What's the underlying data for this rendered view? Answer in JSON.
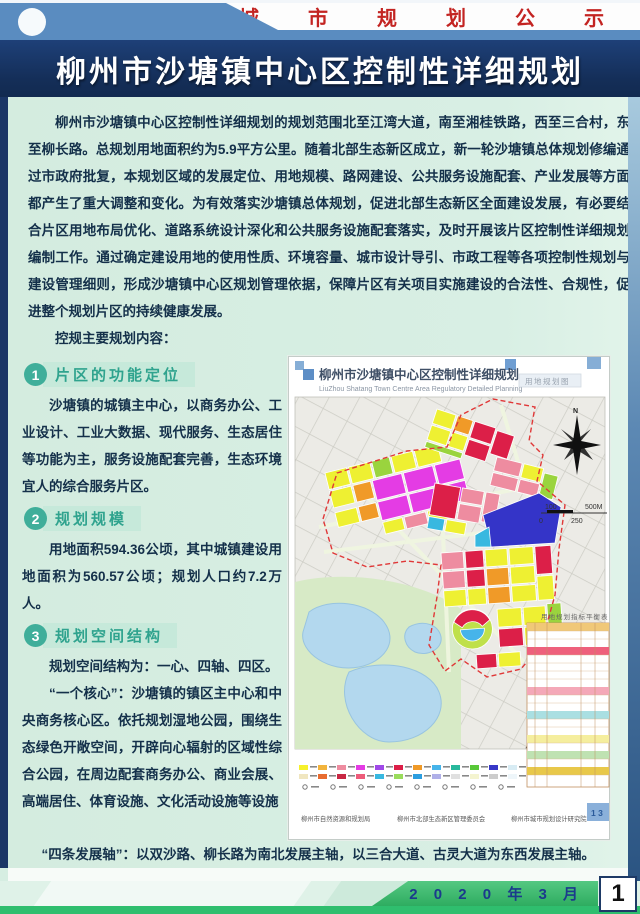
{
  "banner": {
    "title": "城 市 规 划 公 示"
  },
  "header": {
    "title": "柳州市沙塘镇中心区控制性详细规划"
  },
  "intro": {
    "paragraph": "柳州市沙塘镇中心区控制性详细规划的规划范围北至江湾大道，南至湘桂铁路，西至三合村，东至柳长路。总规划用地面积约为5.9平方公里。随着北部生态新区成立，新一轮沙塘镇总体规划修编通过市政府批复，本规划区域的发展定位、用地规模、路网建设、公共服务设施配套、产业发展等方面都产生了重大调整和变化。为有效落实沙塘镇总体规划，促进北部生态新区全面建设发展，有必要结合片区用地布局优化、道路系统设计深化和公共服务设施配套落实，及时开展该片区控制性详细规划编制工作。通过确定建设用地的使用性质、环境容量、城市设计导引、市政工程等各项控制性规划与建设管理细则，形成沙塘镇中心区规划管理依据，保障片区有关项目实施建设的合法性、合规性，促进整个规划片区的持续健康发展。",
    "lead_in": "控规主要规划内容："
  },
  "sections": [
    {
      "num": "1",
      "title": "片区的功能定位",
      "body": "沙塘镇的城镇主中心，以商务办公、工业设计、工业大数据、现代服务、生态居住等功能为主，服务设施配套完善，生态环境宜人的综合服务片区。"
    },
    {
      "num": "2",
      "title": "规划规模",
      "body": "用地面积594.36公顷，其中城镇建设用地面积为560.57公顷；规划人口约7.2万人。"
    },
    {
      "num": "3",
      "title": "规划空间结构",
      "body": "规划空间结构为：一心、四轴、四区。",
      "body2": "“一个核心”：沙塘镇的镇区主中心和中央商务核心区。依托规划湿地公园，围绕生态绿色开敞空间，开辟向心辐射的区域性综合公园，在周边配套商务办公、商业会展、高端居住、体育设施、文化活动设施等设施"
    }
  ],
  "axes_line": "“四条发展轴”：以双沙路、柳长路为南北发展主轴，以三合大道、古灵大道为东西发展主轴。",
  "zones_line": "“四大功能片区”：以柳长路、双沙路、三合大道和古灵大道为功能划分边界，以此将规划区划分为中",
  "map": {
    "title": "柳州市沙塘镇中心区控制性详细规划",
    "subtitle": "LiuZhou Shatang Town Centre Area Regulatory Detailed Planning",
    "corner_label": "用地规划图",
    "north_label": "N",
    "scale": {
      "top_left": "100",
      "top_right": "500M",
      "bottom_left": "0",
      "bottom_mid": "250"
    },
    "table_title": "用地规划指标平衡表",
    "orgs": [
      "柳州市自然资源和规划局",
      "柳州市北部生态新区管理委员会",
      "柳州市城市规划设计研究院"
    ],
    "page_label": "1 3"
  },
  "footer": {
    "date": "2 0 2 0 年 3 月",
    "page_number": "1"
  },
  "colors": {
    "banner_blue": "#5a8cc0",
    "navy": "#142e58",
    "mint": "#d6eee2",
    "badge_teal": "#3fae9a",
    "footer_green": "#2fbe6e",
    "banner_red": "#c32422",
    "date_blue": "#1b3a8c"
  }
}
